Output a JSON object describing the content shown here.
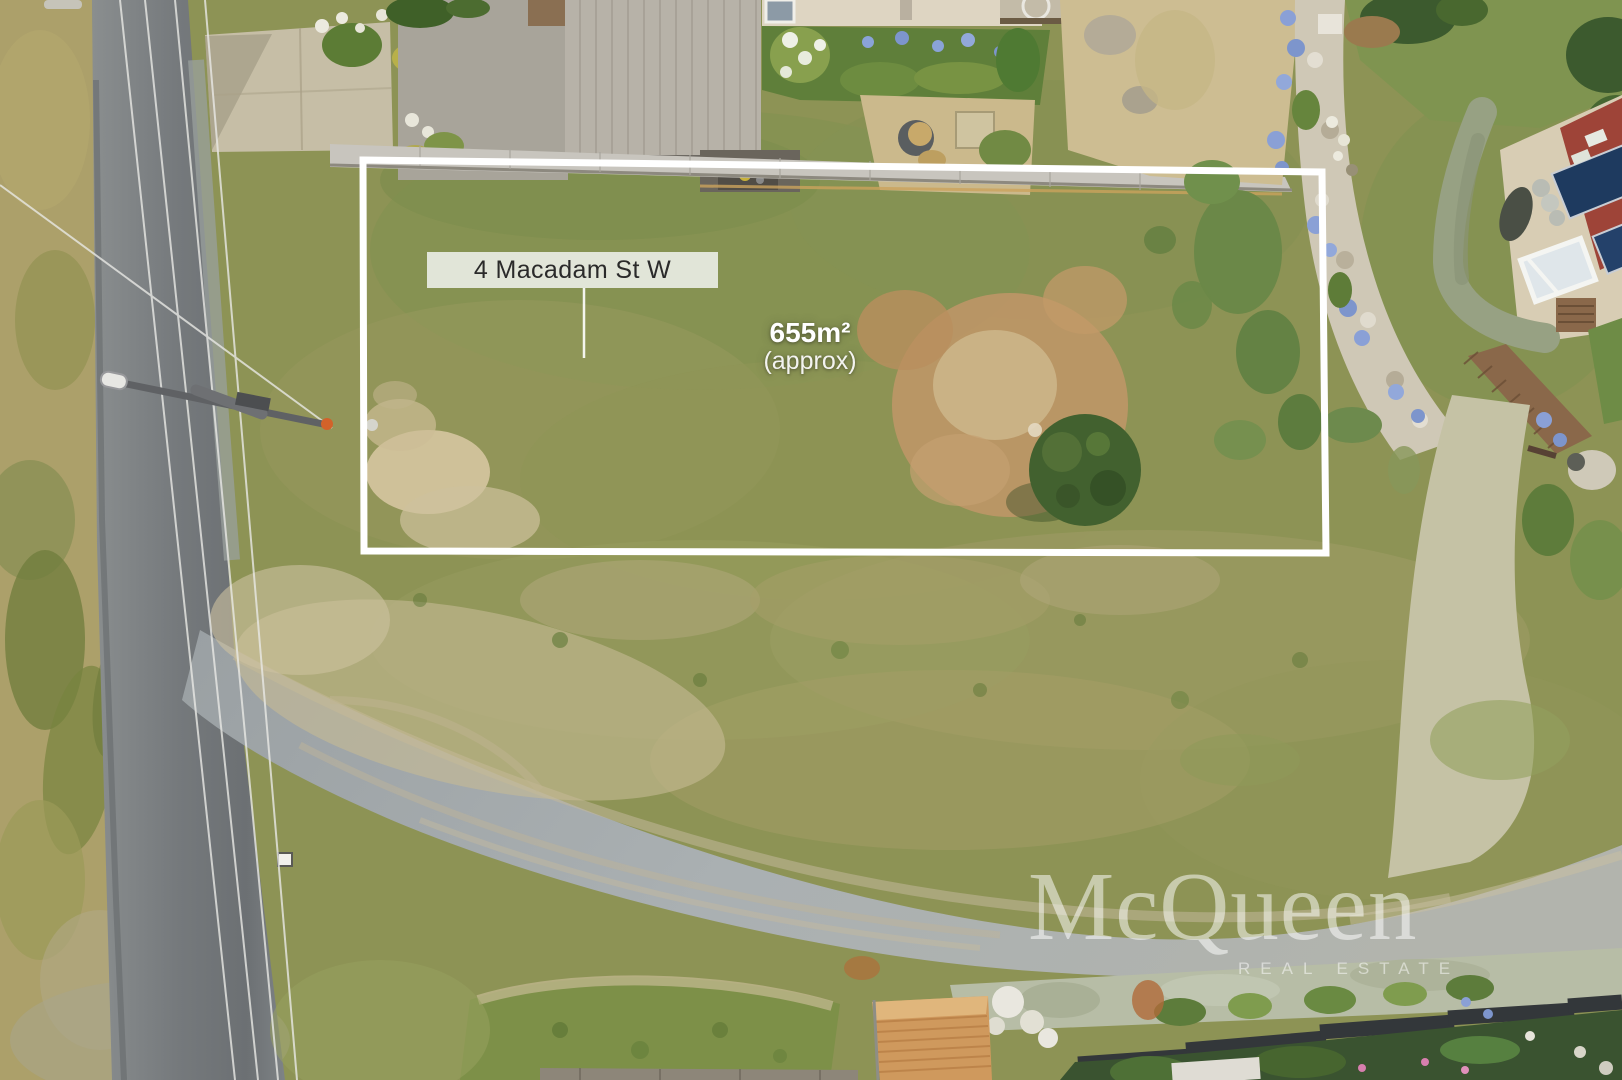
{
  "overlay": {
    "property_label": "4 Macadam St W",
    "area_value": "655m²",
    "area_qualifier": "(approx)",
    "colors": {
      "boundary_line": "#ffffff",
      "label_background": "#eef0eb",
      "label_text": "#2a2a2a",
      "area_text": "#ffffff"
    }
  },
  "watermark": {
    "brand": "McQueen",
    "tagline": "REAL ESTATE"
  }
}
